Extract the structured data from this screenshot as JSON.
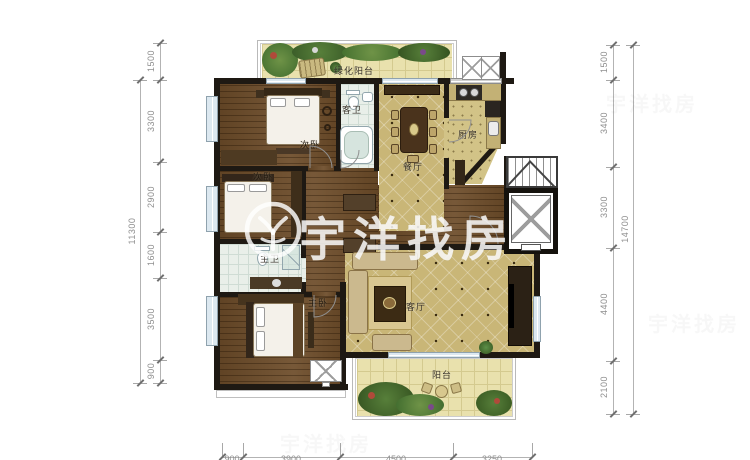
{
  "watermark": {
    "brand": "宇洋找房"
  },
  "rooms": {
    "green_balcony": "绿化阳台",
    "bedroom_top": "次卧",
    "guest_bath": "客卫",
    "dining": "餐厅",
    "kitchen": "厨房",
    "bedroom_mid": "次卧",
    "master_bath": "主卫",
    "master_bedroom": "主卧",
    "living": "客厅",
    "balcony": "阳台"
  },
  "dimensions": {
    "left": {
      "total": "11300",
      "segments": [
        "1500",
        "3300",
        "2900",
        "1600",
        "3500",
        "900"
      ]
    },
    "right": {
      "total": "14700",
      "segments": [
        "1500",
        "3400",
        "3300",
        "4400",
        "2100"
      ]
    },
    "bottom": {
      "segments": [
        "900",
        "3900",
        "4500",
        "3250"
      ]
    }
  },
  "colors": {
    "wall": "#1e1913",
    "wood_floor": "#6d4c29",
    "tile_floor": "#c9b677",
    "sand_floor": "#e9e1ad",
    "bath_floor": "#e9efe9",
    "plants": "#4c7c3a",
    "dimension_text": "#8f8f8f",
    "watermark_text": "#ffffff"
  }
}
